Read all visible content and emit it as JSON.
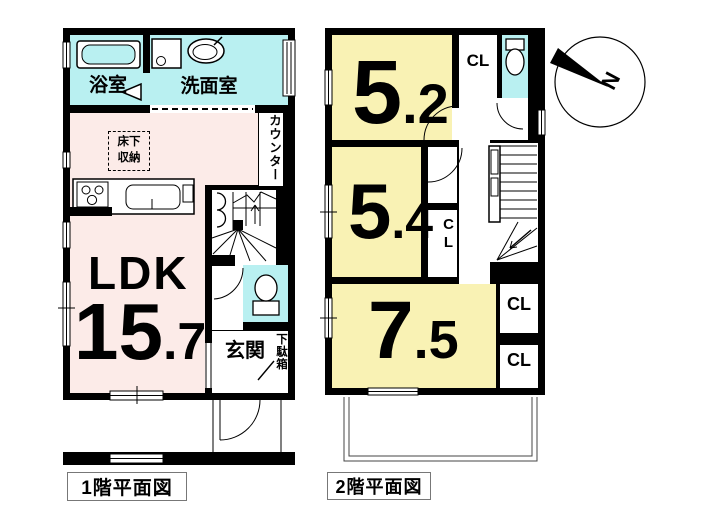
{
  "colors": {
    "wall": "#000000",
    "water": "#b9f0f1",
    "ldk": "#fcebe8",
    "room": "#f9f2b4",
    "paper": "#ffffff"
  },
  "floor1": {
    "caption": "1階平面図",
    "bath": "浴室",
    "washroom": "洗面室",
    "underfloor_line1": "床下",
    "underfloor_line2": "収納",
    "counter": "カウンター",
    "ldk": "LDK",
    "ldk_area_int": "15",
    "ldk_area_dec": ".7",
    "entrance": "玄関",
    "shoe_cabinet": "下駄箱"
  },
  "floor2": {
    "caption": "2階平面図",
    "room_a_int": "5",
    "room_a_dec": ".2",
    "room_b_int": "5",
    "room_b_dec": ".4",
    "room_c_int": "7",
    "room_c_dec": ".5",
    "closet_top": "CL",
    "closet_mid": "CL",
    "closet_right_upper": "CL",
    "closet_right_lower": "CL"
  },
  "compass": {
    "north": "N"
  }
}
